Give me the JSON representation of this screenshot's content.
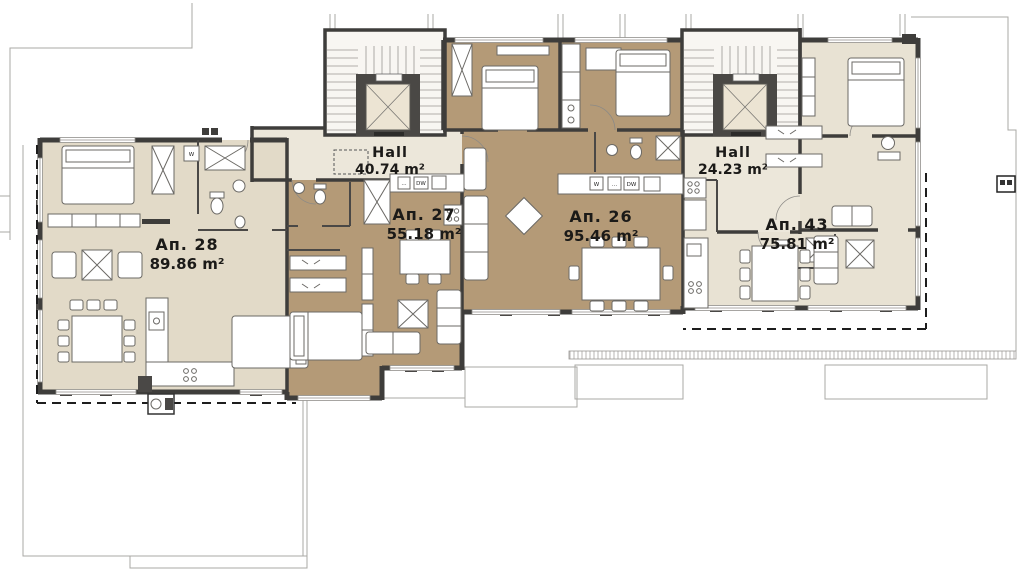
{
  "drawing": {
    "kind": "apartment building floor plan",
    "units": [
      {
        "name": "Ап. 28",
        "area": "89.86 m²"
      },
      {
        "name": "Ап. 27",
        "area": "55.18 m²"
      },
      {
        "name": "Ап. 26",
        "area": "95.46 m²"
      },
      {
        "name": "Ап. 43",
        "area": "75.81 m²"
      }
    ],
    "halls": [
      {
        "name": "Hall",
        "area": "40.74 m²"
      },
      {
        "name": "Hall",
        "area": "24.23 m²"
      }
    ],
    "appliance_labels": {
      "washer": "W",
      "dishwasher": "DW",
      "dots": "..."
    },
    "colors": {
      "unit_light": "#e2dac8",
      "unit_brown": "#b49a77",
      "hall": "#ece7da",
      "unit_cream": "#e8e2d3",
      "stairwell": "#f8f6f2",
      "elevator_frame": "#4a4845",
      "elevator_cab": "#ece4d3",
      "wall": "#3e3d3b"
    }
  }
}
